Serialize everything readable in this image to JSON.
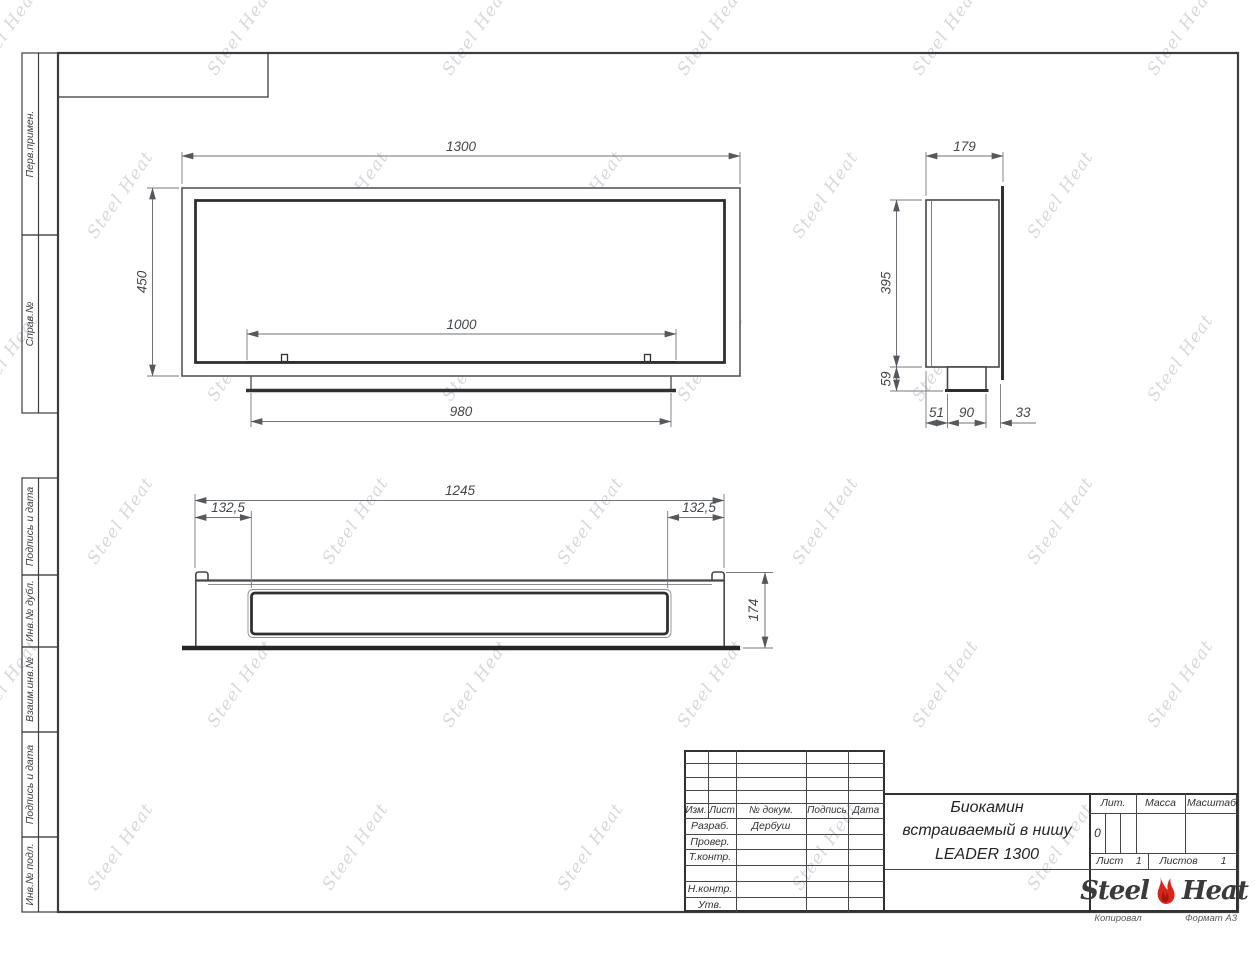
{
  "sheet": {
    "watermark_text": "Steel Heat",
    "footer": {
      "copied": "Копировал",
      "format": "Формат А3"
    }
  },
  "margin_labels": [
    "Перв.примен.",
    "Справ.№",
    "Подпись и дата",
    "Инв.№ дубл.",
    "Взаим.инв.№",
    "Подпись и дата",
    "Инв.№ подл."
  ],
  "dims": {
    "front": {
      "width": "1300",
      "height": "450",
      "opening": "1000",
      "tray": "980"
    },
    "side": {
      "depth": "179",
      "height": "395",
      "box_height": "59",
      "front": "51",
      "box": "90",
      "back": "33"
    },
    "bottom": {
      "width": "1245",
      "offset_left": "132,5",
      "offset_right": "132,5",
      "depth": "174"
    }
  },
  "title_block": {
    "header": {
      "izm": "Изм.",
      "list": "Лист",
      "doc": "№ докум.",
      "sign": "Подпись",
      "date": "Дата"
    },
    "rows": [
      {
        "label": "Разраб.",
        "value": "Дербуш"
      },
      {
        "label": "Провер.",
        "value": ""
      },
      {
        "label": "Т.контр.",
        "value": ""
      },
      {
        "label": "",
        "value": ""
      },
      {
        "label": "Н.контр.",
        "value": ""
      },
      {
        "label": "Утв.",
        "value": ""
      }
    ],
    "title": {
      "line1": "Биокамин",
      "line2": "встраиваемый в нишу",
      "line3": "LEADER 1300"
    },
    "lit": {
      "label": "Лит.",
      "value": "0"
    },
    "mass_label": "Масса",
    "scale_label": "Масштаб",
    "sheet_no": {
      "label": "Лист",
      "value": "1"
    },
    "sheet_total": {
      "label": "Листов",
      "value": "1"
    },
    "logo": {
      "word1": "Steel",
      "word2": "Heat"
    }
  },
  "colors": {
    "line_main": "#45474a",
    "line_heavy": "#2e3032",
    "line_dim": "#6f7276",
    "flame_red": "#d9261c",
    "watermark": "#d7d8dc"
  }
}
